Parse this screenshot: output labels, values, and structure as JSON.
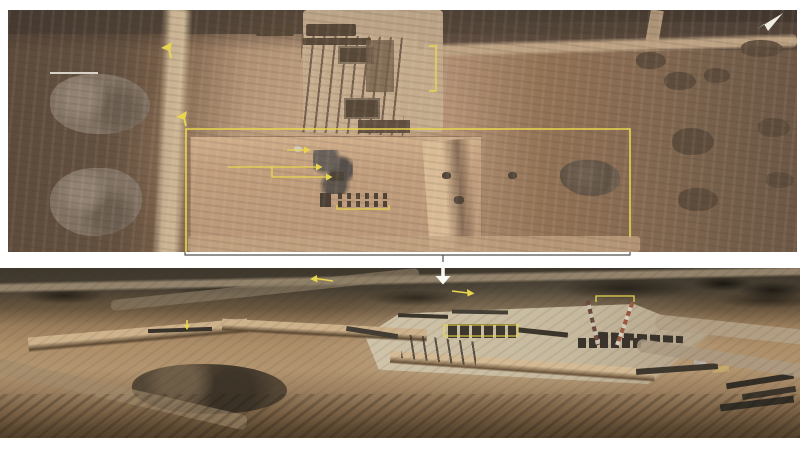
{
  "canvas": {
    "width": 800,
    "height": 450,
    "background_color": "#ffffff"
  },
  "palette": {
    "annotation_yellow": "#e9d64e",
    "annotation_white": "#fbfaf6",
    "connector_gray": "#55504a",
    "scale_bar_gray": "#d9d3c7",
    "pointer_icon_white": "#efece4"
  },
  "top_photo": {
    "description": "Overhead satellite image of a desert construction staging site annotated with yellow analyst markings",
    "region": {
      "x": 8,
      "y": 10,
      "width": 789,
      "height": 242
    }
  },
  "bottom_photo": {
    "description": "Oblique aerial photo of the same graded construction pad with pontoon sections and two striped crane masts",
    "region": {
      "x": 0,
      "y": 268,
      "width": 800,
      "height": 170
    }
  },
  "overlays": [
    {
      "name": "scale-bar",
      "shape": "line",
      "points": "50,73 98,73",
      "color": "#d9d3c7",
      "width": 2
    },
    {
      "name": "route-marker-icon-1",
      "shape": "polygon",
      "points": "161,48 172,42 170,51",
      "color": "#e9d64e"
    },
    {
      "name": "route-marker-stem-1",
      "shape": "line",
      "points": "169,49 171,58",
      "color": "#e9d64e",
      "width": 2
    },
    {
      "name": "route-marker-icon-2",
      "shape": "polygon",
      "points": "176,117 187,111 185,120",
      "color": "#e9d64e"
    },
    {
      "name": "route-marker-stem-2",
      "shape": "line",
      "points": "184,118 186,126",
      "color": "#e9d64e",
      "width": 2
    },
    {
      "name": "pier-bracket",
      "shape": "polyline",
      "points": "429,46 436,46 436,91 429,91",
      "color": "#e9d64e",
      "width": 1.4
    },
    {
      "name": "leader-arrow-short",
      "shape": "line",
      "points": "287,150 304,150",
      "color": "#e9d64e",
      "width": 1.3
    },
    {
      "name": "leader-arrow-short-head",
      "shape": "polygon",
      "points": "304,146.5 310.5,150 304,153.5",
      "color": "#e9d64e"
    },
    {
      "name": "leader-arrow-long",
      "shape": "line",
      "points": "228,167 316,167",
      "color": "#e9d64e",
      "width": 1.3
    },
    {
      "name": "leader-arrow-long-head",
      "shape": "polygon",
      "points": "316,163.5 322.5,167 316,170.5",
      "color": "#e9d64e"
    },
    {
      "name": "leader-arrow-branch",
      "shape": "polyline",
      "points": "272,167 272,177 326,177",
      "color": "#e9d64e",
      "width": 1.3
    },
    {
      "name": "leader-arrow-branch-head",
      "shape": "polygon",
      "points": "326,173.5 332.5,177 326,180.5",
      "color": "#e9d64e"
    },
    {
      "name": "vehicle-row-bracket",
      "shape": "polyline",
      "points": "337,205 337,209 389,209 389,205",
      "color": "#e9d64e",
      "width": 1.3
    },
    {
      "name": "detail-region-outline",
      "shape": "polyline",
      "points": "186,252 186,129 630,129 630,237",
      "color": "#e9d64e",
      "width": 1.6
    },
    {
      "name": "connector-bracket",
      "shape": "polyline",
      "points": "185,252 185,255 630,255 630,252",
      "color": "#55504a",
      "width": 1.2
    },
    {
      "name": "connector-center-tick",
      "shape": "line",
      "points": "443,255 443,263",
      "color": "#55504a",
      "width": 1.2
    },
    {
      "name": "zoom-down-arrow-stem",
      "shape": "line",
      "points": "443,262 443,277",
      "color": "#fbfaf6",
      "width": 3.5
    },
    {
      "name": "zoom-down-arrow-head",
      "shape": "polygon",
      "points": "435.5,276 450.5,276 443,284.5",
      "color": "#fbfaf6"
    },
    {
      "name": "compass-pointer-icon",
      "shape": "polygon",
      "points": "757,29 783,13 768,31 764,24",
      "color": "#efece4"
    },
    {
      "name": "bottom-left-arrow-line",
      "shape": "line",
      "points": "316,278.5 333,281",
      "color": "#e9d64e",
      "width": 1.6
    },
    {
      "name": "bottom-left-arrow-head",
      "shape": "polygon",
      "points": "317,275 310,279 317.5,282.5",
      "color": "#e9d64e"
    },
    {
      "name": "bottom-right-arrow-line",
      "shape": "line",
      "points": "452,291 468,293",
      "color": "#e9d64e",
      "width": 1.6
    },
    {
      "name": "bottom-right-arrow-head",
      "shape": "polygon",
      "points": "467,289 474.5,293.5 467.5,296.5",
      "color": "#e9d64e"
    },
    {
      "name": "fence-marker-stem",
      "shape": "line",
      "points": "187,320 187,326",
      "color": "#e9d64e",
      "width": 1.6
    },
    {
      "name": "fence-marker-head",
      "shape": "polygon",
      "points": "184,325 190,325 187,330",
      "color": "#e9d64e"
    },
    {
      "name": "crane-bracket",
      "shape": "polyline",
      "points": "596,302 596,296 634,296 634,302",
      "color": "#e9d64e",
      "width": 1.3
    },
    {
      "name": "modules-outline",
      "shape": "rect",
      "points": "444,325 74,11",
      "color": "#e9d64e",
      "width": 1.1
    }
  ]
}
